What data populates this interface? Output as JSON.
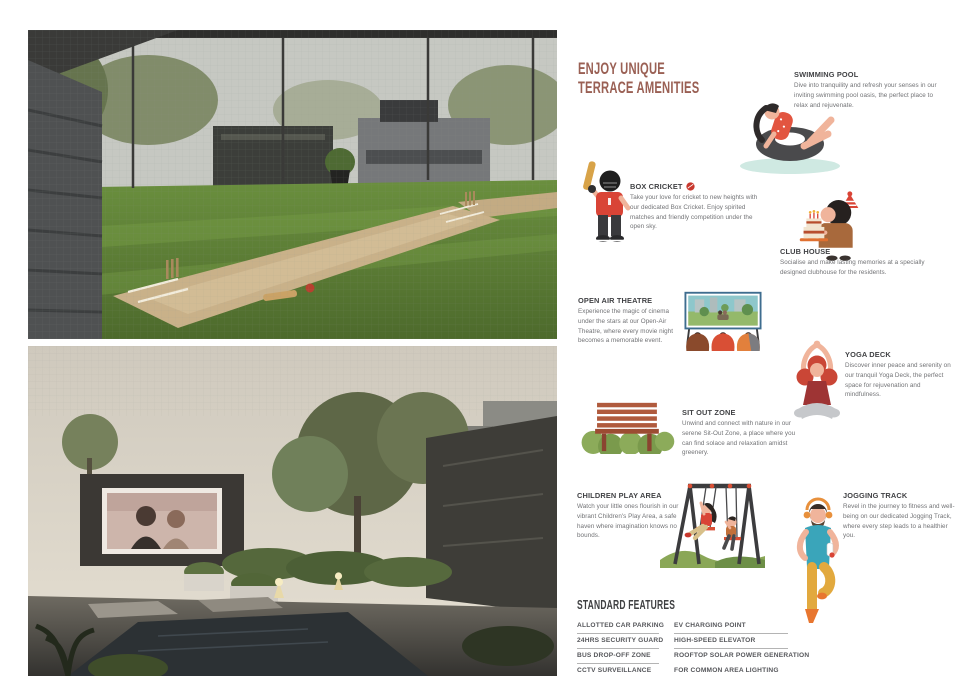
{
  "header": {
    "title_line1": "ENJOY UNIQUE",
    "title_line2": "TERRACE AMENITIES",
    "title_color": "#9a6054"
  },
  "amenities": [
    {
      "icon": "swimming-pool-illustration",
      "title": "SWIMMING POOL",
      "desc": "Dive into tranquility and refresh your senses in our inviting swimming pool oasis, the perfect place to relax and rejuvenate."
    },
    {
      "icon": "box-cricket-batsman-illustration",
      "title": "BOX CRICKET",
      "desc": "Take your love for cricket to new heights with our dedicated Box Cricket. Enjoy spirited matches and friendly competition under the open sky."
    },
    {
      "icon": "club-house-cake-boy-illustration",
      "title": "CLUB HOUSE",
      "desc": "Socialise and make lasting memories at a specially designed clubhouse for the residents."
    },
    {
      "icon": "open-air-theatre-screen-illustration",
      "title": "OPEN AIR THEATRE",
      "desc": "Experience the magic of cinema under the stars at our Open-Air Theatre, where every movie night becomes a memorable event."
    },
    {
      "icon": "yoga-pose-illustration",
      "title": "YOGA DECK",
      "desc": "Discover inner peace and serenity on our tranquil Yoga Deck, the perfect space for rejuvenation and mindfulness."
    },
    {
      "icon": "garden-bench-illustration",
      "title": "SIT OUT ZONE",
      "desc": "Unwind and connect with nature in our serene Sit-Out Zone, a place where you can find solace and relaxation amidst greenery."
    },
    {
      "icon": "swing-set-children-illustration",
      "title": "CHILDREN PLAY AREA",
      "desc": "Watch your little ones flourish in our vibrant Children's Play Area, a safe haven where imagination knows no bounds."
    },
    {
      "icon": "jogging-runner-illustration",
      "title": "JOGGING TRACK",
      "desc": "Revel in the journey to fitness and well-being on our dedicated Jogging Track, where every step leads to a healthier you."
    }
  ],
  "standard_features": {
    "heading": "STANDARD FEATURES",
    "left": [
      "ALLOTTED CAR PARKING",
      "24HRS SECURITY GUARD",
      "BUS DROP-OFF ZONE",
      "CCTV SURVEILLANCE"
    ],
    "right": [
      "EV CHARGING POINT",
      "HIGH-SPEED  ELEVATOR",
      "ROOFTOP SOLAR POWER GENERATION",
      "FOR COMMON AREA LIGHTING"
    ]
  }
}
